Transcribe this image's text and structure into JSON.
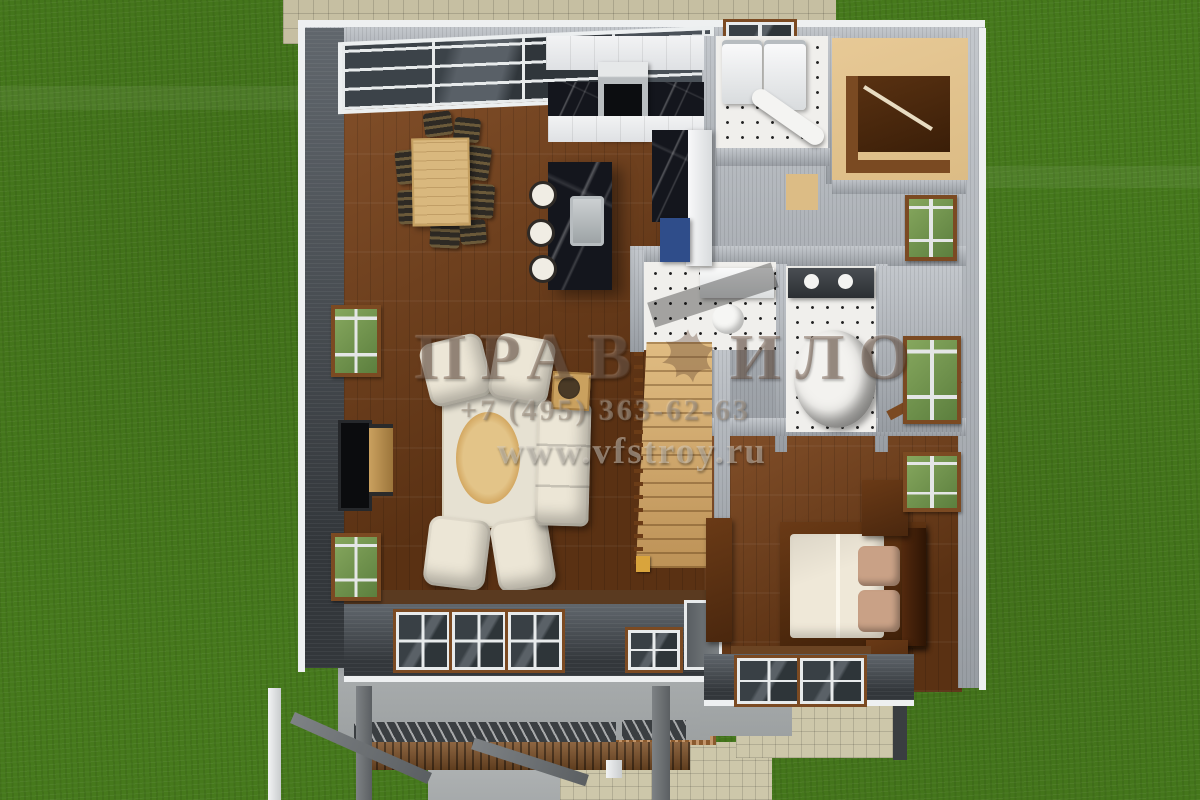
{
  "watermark": {
    "logo_left": "ПРАВ",
    "logo_right": "ИЛО",
    "logo_icon": "bird-icon",
    "phone": "+7 (495) 363-62-63",
    "website": "www.vfstroy.ru"
  },
  "palette": {
    "grass": "#46791c",
    "patio": "#c6bfa2",
    "concrete": "#a6aaab",
    "paver": "#cdc7aa",
    "deck_wood": "#7e5128",
    "railing": "#3a3e41",
    "porch": "#a7abac",
    "wall_cap": "#eef0f1",
    "wall_face": "#b3b8bd",
    "wall_dark": "#43474c",
    "wood_floor": "#74431d",
    "stair_wood": "#d3ad72",
    "carpet_tan": "#dcbc85",
    "tile": "#f0efec",
    "marble_dark": "#14161d",
    "cabinet_white": "#dfe1e4",
    "cabinet_blue": "#2f4d8a",
    "table_wood": "#d9b87e",
    "chair_dark": "#2e2a24",
    "rug_cream": "#e6e1d2",
    "rug_oval": "#d4a963",
    "sofa_cream": "#ece6d6",
    "bed_linen": "#efe8d8",
    "pillow": "#c9a186",
    "furniture_dark": "#4a270e",
    "window_green": "#5c7f3e",
    "glass_dark": "#2e3539",
    "frame_brown": "#7b4a22",
    "watermark_brown": "rgba(94,64,44,0.40)",
    "watermark_gray": "rgba(160,145,130,0.55)",
    "watermark_light": "rgba(213,208,198,0.50)"
  }
}
